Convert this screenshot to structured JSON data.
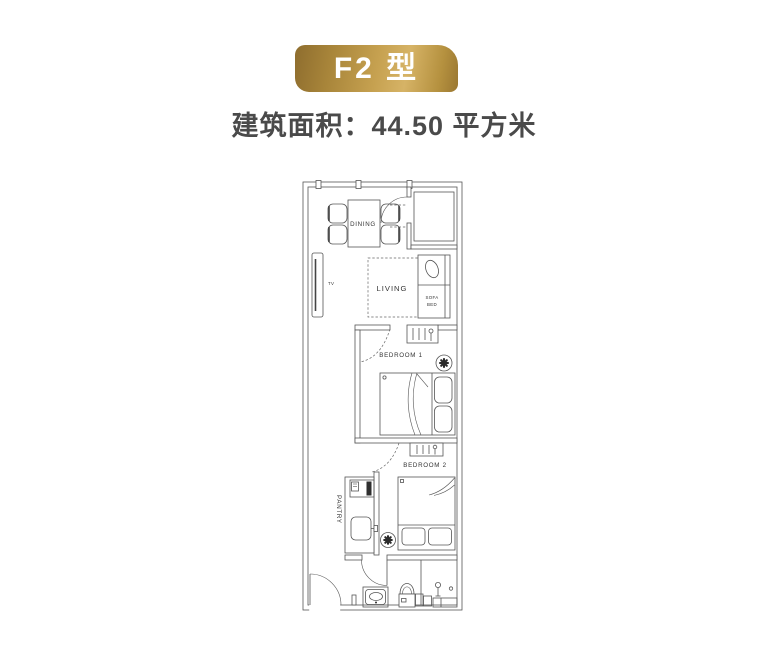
{
  "badge": {
    "label": "F2 型"
  },
  "subtitle": "建筑面积：44.50 平方米",
  "colors": {
    "gold_dark": "#8e6d2e",
    "gold_mid": "#c6a150",
    "gold_light": "#d6b366",
    "badge_text": "#ffffff",
    "subtitle_text": "#4a4a4a",
    "plan_line": "#555555"
  },
  "plan": {
    "labels": {
      "dining": "DINING",
      "living": "LIVING",
      "sofa_line1": "SOFA",
      "sofa_line2": "BED",
      "tv": "TV",
      "bedroom1": "BEDROOM 1",
      "bedroom2": "BEDROOM 2",
      "pantry": "PANTRY"
    }
  }
}
